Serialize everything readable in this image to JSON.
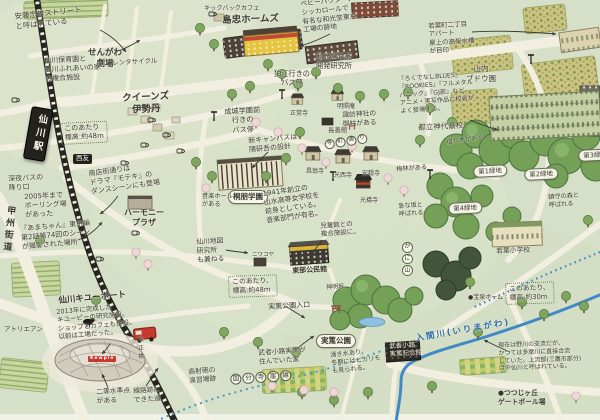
{
  "colors": {
    "background": "#d6e0c8",
    "road": "#f2efe1",
    "railway": "#26251f",
    "river": "#4189c6",
    "forest": "#74a058",
    "forest_dark": "#42543a",
    "field": "#cfc083",
    "accent_red": "#c6392f",
    "ink": "#39382e"
  },
  "icons": {
    "bus-stop-icon": "T-pole",
    "coffee-cup-icon": "cup",
    "torii-icon": "shrine gate",
    "crow-icon": "bird",
    "red-van-icon": "van",
    "railway-icon": "ladder line"
  },
  "annotations": [
    {
      "name": "note-ando-street",
      "text": "安藤忠雄ストリート\nと呼ばれている",
      "x": 14,
      "y": 12,
      "size": 7.5,
      "rot": -6
    },
    {
      "name": "label-sengawa-theater",
      "text": "せんがわ\n劇場",
      "x": 88,
      "y": 48,
      "size": 8.5,
      "cls": "bold center"
    },
    {
      "name": "note-hoikuen-fureai",
      "text": "仙川保育園と\n仙川ふれあいの家\nの複合施設",
      "x": 44,
      "y": 57,
      "size": 7,
      "rot": -3
    },
    {
      "name": "label-rental-cycle",
      "text": "レンタサイクル",
      "x": 112,
      "y": 59,
      "size": 6.5,
      "rot": -3
    },
    {
      "name": "label-queens-isetan",
      "text": "クイーンズ\n伊勢丹",
      "x": 122,
      "y": 93,
      "size": 9.5,
      "rot": -3,
      "cls": "bold center"
    },
    {
      "name": "note-elevation-48-station",
      "text": "このあたり\n標高:約48m",
      "x": 60,
      "y": 123,
      "size": 7,
      "rot": -3,
      "cls": "dotbox"
    },
    {
      "name": "label-kickback-cafe",
      "text": "キックバックカフェ",
      "x": 204,
      "y": 5,
      "size": 6.2
    },
    {
      "name": "label-shimachu",
      "text": "島忠ホームズ",
      "x": 222,
      "y": 15,
      "size": 9.5,
      "rot": -2,
      "cls": "bold"
    },
    {
      "name": "note-wakodo-site",
      "text": "ベビーパウダー、\nシッカロールで\n有名な和光堂東京\n工場の跡地",
      "x": 300,
      "y": 0,
      "size": 6.8,
      "rot": -6
    },
    {
      "name": "label-wakodo-lab",
      "text": "和光堂食品\n開発研究所",
      "x": 316,
      "y": 52,
      "size": 7.2,
      "cls": "center"
    },
    {
      "name": "label-bus-komae",
      "text": "狛江行きの\nバス停",
      "x": 274,
      "y": 69,
      "size": 7.2,
      "cls": "center"
    },
    {
      "name": "label-bus-seijo",
      "text": "成城学園前\n行きの\nバス停",
      "x": 224,
      "y": 107,
      "size": 7.2,
      "rot": -3,
      "cls": "center"
    },
    {
      "name": "note-wakaba-apartment",
      "text": "若葉町二丁目\nアパート\n屋上の高架水槽\nが目印",
      "x": 428,
      "y": 22,
      "size": 6.5,
      "rot": -3
    },
    {
      "name": "label-yamauchi-vineyard",
      "text": "山内\nブドウ園",
      "x": 466,
      "y": 64,
      "size": 7.5,
      "cls": "center"
    },
    {
      "name": "note-jindai-anime",
      "text": "『ろくでなしBLUES』\n『ROOKIES』『フルメタル\nパニック』『GJ部』など、\nアニメ・実写作品に校舎が\nよく登場する。",
      "x": 398,
      "y": 76,
      "size": 6.2,
      "rot": -4
    },
    {
      "name": "label-jindai-highschool",
      "text": "都立神代高校",
      "x": 418,
      "y": 123,
      "size": 7.5,
      "rot": -3
    },
    {
      "name": "label-ryokuchi-1",
      "text": "第1緑地",
      "x": 473,
      "y": 166,
      "size": 6.5,
      "rot": -3,
      "cls": "oval"
    },
    {
      "name": "label-ryokuchi-2",
      "text": "第2緑地",
      "x": 524,
      "y": 169,
      "size": 6.5,
      "rot": -3,
      "cls": "oval"
    },
    {
      "name": "label-ryokuchi-3",
      "text": "第3緑地",
      "x": 578,
      "y": 150,
      "size": 6.5,
      "rot": -3,
      "cls": "oval"
    },
    {
      "name": "label-ryokuchi-4",
      "text": "第4緑地",
      "x": 448,
      "y": 203,
      "size": 6.5,
      "rot": -3,
      "cls": "oval"
    },
    {
      "name": "note-chinju-no-mori",
      "text": "鎮守の森と\n呼ばれる",
      "x": 548,
      "y": 194,
      "size": 6.2,
      "rot": -4
    },
    {
      "name": "note-mistletoe",
      "text": "宿り木がある",
      "x": 446,
      "y": 139,
      "size": 6.2,
      "rot": -8
    },
    {
      "name": "note-plum-grove",
      "text": "梅林がある",
      "x": 396,
      "y": 166,
      "size": 6.2,
      "rot": -4
    },
    {
      "name": "note-steep-slope",
      "text": "急な坂と\n呼ばれる",
      "x": 398,
      "y": 203,
      "size": 6.2,
      "rot": -4
    },
    {
      "name": "label-suwa-onbashira",
      "text": "諏訪神社の\n御柱がある",
      "x": 342,
      "y": 111,
      "size": 6.8,
      "rot": -3
    },
    {
      "name": "label-teramachi-dori",
      "text": "寺町通り",
      "x": 324,
      "y": 140,
      "size": 5.5,
      "rot": -9,
      "cls": "circled"
    },
    {
      "name": "label-chozenkan",
      "text": "長善館",
      "x": 328,
      "y": 126,
      "size": 6.5
    },
    {
      "name": "label-shogakuji",
      "text": "正覚寺",
      "x": 290,
      "y": 110,
      "size": 6
    },
    {
      "name": "label-meishoan",
      "text": "明照庵",
      "x": 337,
      "y": 103,
      "size": 6
    },
    {
      "name": "label-shoohji",
      "text": "昌翁寺",
      "x": 306,
      "y": 168,
      "size": 6
    },
    {
      "name": "label-kosaiji",
      "text": "光西寺",
      "x": 334,
      "y": 172,
      "size": 6
    },
    {
      "name": "label-annonji",
      "text": "安穏寺",
      "x": 362,
      "y": 170,
      "size": 6
    },
    {
      "name": "label-kokyoji",
      "text": "光橋寺",
      "x": 360,
      "y": 197,
      "size": 6
    },
    {
      "name": "note-kengo-kuma",
      "text": "新キャンパスは\n隈研吾の設計",
      "x": 248,
      "y": 137,
      "size": 7,
      "rot": -5
    },
    {
      "name": "label-toho-gakuen",
      "text": "桐朋学園",
      "x": 228,
      "y": 190,
      "size": 7.5,
      "cls": "oval bold"
    },
    {
      "name": "note-toho-history",
      "text": "1941年創立の\n山水高等女学校を\n前身としている。\n音楽部門が有名。",
      "x": 262,
      "y": 190,
      "size": 7,
      "rot": -8
    },
    {
      "name": "note-music-hall",
      "text": "音楽ホール\nがある",
      "x": 202,
      "y": 193,
      "size": 6.2
    },
    {
      "name": "label-seiyu",
      "text": "西友",
      "x": 73,
      "y": 154,
      "size": 6.5,
      "cls": "sign"
    },
    {
      "name": "note-late-night-bus",
      "text": "深夜バスの\n降り口",
      "x": 8,
      "y": 175,
      "size": 7,
      "rot": -3
    },
    {
      "name": "note-bowling",
      "text": "2005年まで\nボーリング場\nがあった",
      "x": 24,
      "y": 193,
      "size": 7,
      "rot": -3
    },
    {
      "name": "note-moteki",
      "text": "商店街通りは\nドラマ『モテキ』の\nダンスシーンにも登場",
      "x": 88,
      "y": 170,
      "size": 7,
      "rot": -8
    },
    {
      "name": "label-harmony-plaza",
      "text": "ハーモニー\nプラザ",
      "x": 124,
      "y": 208,
      "size": 8,
      "cls": "center bold"
    },
    {
      "name": "note-amachan",
      "text": "『あまちゃん』東京編\n第2話第74回のシーン\nが撮影された場所",
      "x": 20,
      "y": 225,
      "size": 7,
      "rot": -5
    },
    {
      "name": "label-koshu-kaido",
      "text": "甲州街道",
      "x": 4,
      "y": 205,
      "size": 9,
      "rot": 6,
      "cls": "vert bold"
    },
    {
      "name": "label-chizu-lab",
      "text": "仙川地図\n研究所\nも兼ねる",
      "x": 196,
      "y": 238,
      "size": 6.8,
      "rot": -3
    },
    {
      "name": "label-niwakoya",
      "text": "ニワコヤ",
      "x": 252,
      "y": 252,
      "size": 5.5
    },
    {
      "name": "label-tobu-kominkan",
      "text": "東部公民館",
      "x": 292,
      "y": 267,
      "size": 7,
      "rot": -3,
      "cls": "bold"
    },
    {
      "name": "note-jidokan-fukugo",
      "text": "児童館との\n複合施設に。",
      "x": 320,
      "y": 222,
      "size": 6.5,
      "rot": -4
    },
    {
      "name": "label-kewport",
      "text": "仙川キユーポート",
      "x": 58,
      "y": 296,
      "size": 8.5,
      "rot": -5,
      "cls": "bold"
    },
    {
      "name": "note-kewport",
      "text": "2013年に完成した\nキユーピーの研究施設。\nショップとカフェも併設。\n以前は工場だった。",
      "x": 56,
      "y": 308,
      "size": 6.5,
      "rot": -5
    },
    {
      "name": "label-kewpie-sign",
      "text": "Kewpie",
      "x": 88,
      "y": 356,
      "size": 4.5,
      "cls": "kewpie"
    },
    {
      "name": "label-atelier-an",
      "text": "アトリエアン",
      "x": 4,
      "y": 325,
      "size": 6.5
    },
    {
      "name": "note-benchmark",
      "text": "二等水準点\nがある",
      "x": 96,
      "y": 388,
      "size": 6.8,
      "rot": -3
    },
    {
      "name": "note-rail-trace-road",
      "text": "線路跡に\nできた道",
      "x": 133,
      "y": 387,
      "size": 6.8,
      "rot": -3
    },
    {
      "name": "note-aa-gun-site",
      "text": "高射砲の\n演習場跡",
      "x": 188,
      "y": 368,
      "size": 6.8,
      "rot": -5
    },
    {
      "name": "note-elevation-48-park",
      "text": "このあたり、\n標高:約48m",
      "x": 228,
      "y": 276,
      "size": 6.8,
      "rot": -2,
      "cls": "dotbox"
    },
    {
      "name": "label-saneatsu-entrance",
      "text": "実篤公園入口",
      "x": 268,
      "y": 303,
      "size": 7,
      "rot": -3
    },
    {
      "name": "label-shinmei-zaka",
      "text": "神明坂",
      "x": 326,
      "y": 284,
      "size": 6,
      "rot": -3
    },
    {
      "name": "label-saneatsu-park",
      "text": "実篤公園",
      "x": 316,
      "y": 334,
      "size": 7.5,
      "cls": "oval bold"
    },
    {
      "name": "note-saneatsu-house",
      "text": "武者小路実篤が\n住んでいた家",
      "x": 258,
      "y": 349,
      "size": 6.8,
      "rot": -4
    },
    {
      "name": "note-spring-water",
      "text": "湧き水あり。\n冬期にはヒカリモ\nも見られる。",
      "x": 330,
      "y": 352,
      "size": 6.2,
      "rot": -6
    },
    {
      "name": "label-kaniyama",
      "text": "かに山",
      "x": 402,
      "y": 242,
      "size": 6,
      "cls": "circled vertcol"
    },
    {
      "name": "label-kokubunji-gaisen",
      "text": "国分寺崖線",
      "x": 230,
      "y": 374,
      "size": 6.5,
      "rot": -4,
      "cls": "circled"
    },
    {
      "name": "label-irimagawa",
      "text": "入間川(いりまがわ)",
      "x": 415,
      "y": 334,
      "size": 8.5,
      "rot": -10,
      "cls": "river-label"
    },
    {
      "name": "note-irimagawa",
      "text": "現在は野川の支流だが、\nかつては多摩川に直接合流\nしていた。上流部(三鷹市部分)\nは中仙川と呼ばれている。",
      "x": 498,
      "y": 342,
      "size": 6,
      "rot": -2
    },
    {
      "name": "note-elevation-30",
      "text": "このあたり、\n標高:約30m",
      "x": 505,
      "y": 283,
      "size": 6.8,
      "rot": -2,
      "cls": "dotbox"
    },
    {
      "name": "label-saneatsu-museum",
      "text": "武者小路\n実篤記念館",
      "x": 389,
      "y": 342,
      "size": 6.5,
      "rot": -3,
      "cls": "on-dark"
    },
    {
      "name": "label-hosen-home",
      "text": "●宝泉ホーム",
      "x": 468,
      "y": 294,
      "size": 6
    },
    {
      "name": "label-gateball",
      "text": "●つつじヶ丘\nゲートボール場",
      "x": 498,
      "y": 389,
      "size": 6.8,
      "cls": "bold"
    },
    {
      "name": "label-wakaba-elementary",
      "text": "若葉小学校",
      "x": 496,
      "y": 247,
      "size": 6.8,
      "rot": -2
    },
    {
      "name": "label-taisho-bashi",
      "text": "大正橋",
      "x": 136,
      "y": 336,
      "size": 5.5,
      "cls": "vert"
    },
    {
      "name": "label-sengawa-station",
      "text": "仙川駅",
      "x": 32,
      "y": 106,
      "size": 9.5,
      "rot": 10,
      "cls": "station bold"
    }
  ]
}
